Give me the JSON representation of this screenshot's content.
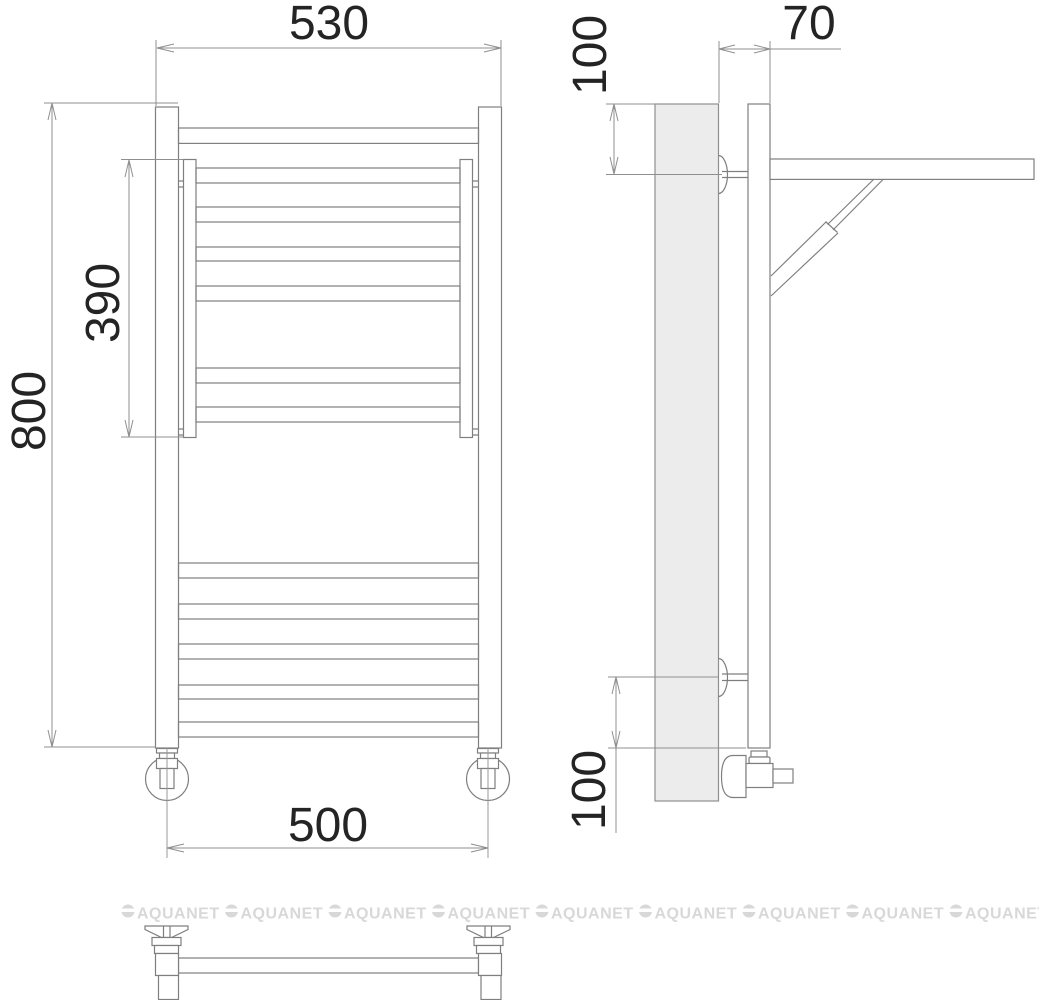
{
  "drawing": {
    "type": "towel-rail-technical-drawing",
    "views": {
      "front": "front view of ladder towel rail",
      "side": "side view with wall panel, shelf bracket and valves",
      "bottom": "detail view of floor feet and connecting tube"
    },
    "dimensions": {
      "front_width": "530",
      "overall_height": "800",
      "heated_section_height": "390",
      "feet_spacing": "500",
      "wall_clearance": "70",
      "top_bracket_offset": "100",
      "bottom_bracket_offset": "100"
    },
    "watermark": {
      "label": "AQUANET",
      "count": 9
    },
    "colors": {
      "background": "#ffffff",
      "line": "#7f7f7f",
      "dimension_line": "#8f8f8f",
      "dimension_text": "#242424",
      "wall_panel_fill": "#ececec",
      "watermark": "#d8d8d8"
    }
  }
}
